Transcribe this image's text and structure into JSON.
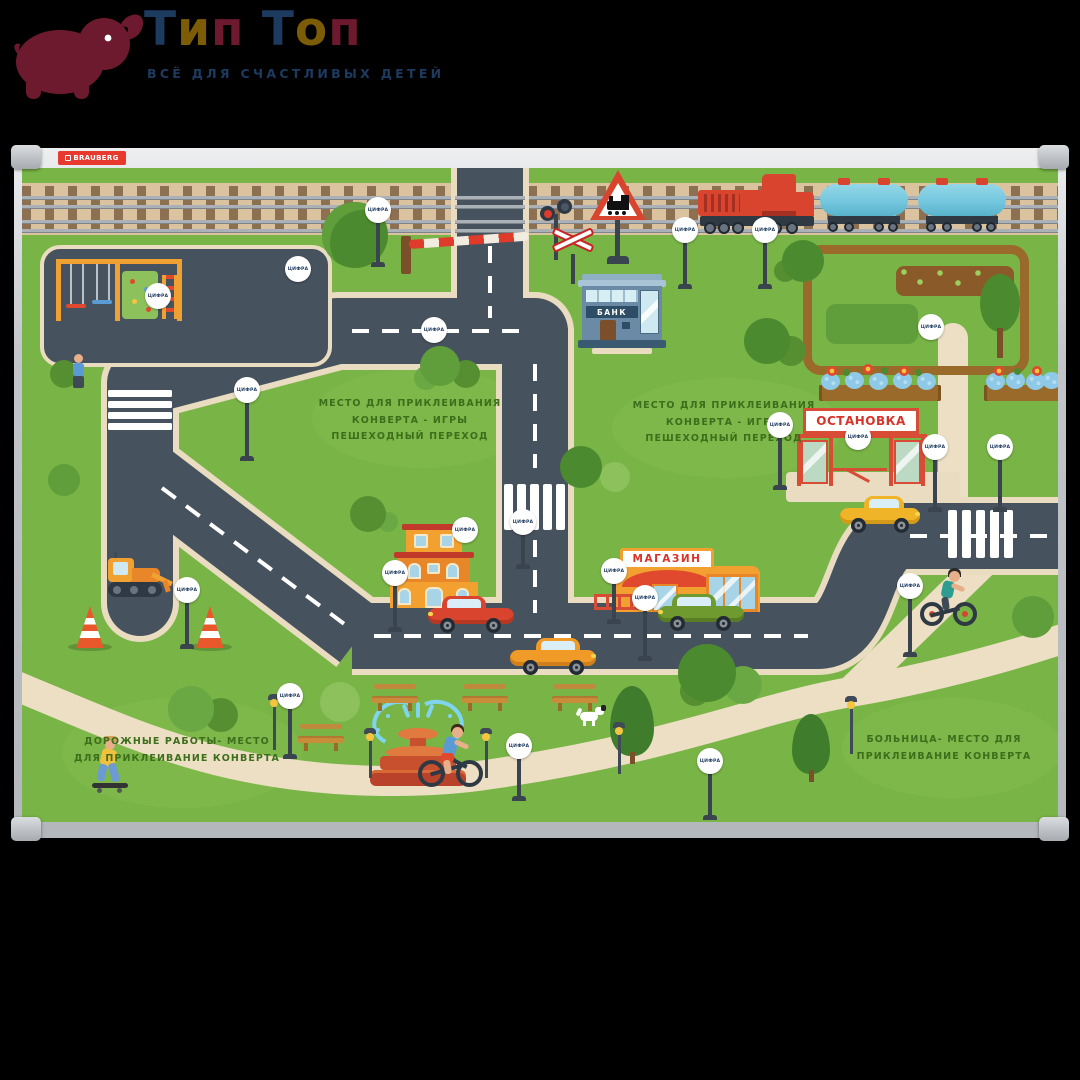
{
  "logo": {
    "brand_letters": [
      {
        "ch": "Т"
      },
      {
        "ch": "и"
      },
      {
        "ch": "п"
      },
      {
        "ch": "Т"
      },
      {
        "ch": "о"
      },
      {
        "ch": "п"
      }
    ],
    "tagline": "ВСЁ ДЛЯ СЧАСТЛИВЫХ ДЕТЕЙ",
    "colors": {
      "maroon": "#6e1a2e",
      "navy": "#1d3a5f",
      "gold": "#7d5c07"
    }
  },
  "board": {
    "brand_label": "BRAUBERG"
  },
  "map": {
    "marker_label": "ЦИФРА",
    "signs": {
      "bank": "БАНК",
      "shop": "МАГАЗИН",
      "bus_stop": "ОСТАНОВКА"
    },
    "notes": {
      "envelope_left": [
        "МЕСТО ДЛЯ ПРИКЛЕИВАНИЯ",
        "КОНВЕРТА - ИГРЫ",
        "ПЕШЕХОДНЫЙ ПЕРЕХОД"
      ],
      "envelope_right": [
        "МЕСТО ДЛЯ ПРИКЛЕИВАНИЯ",
        "КОНВЕРТА - ИГРЫ",
        "ПЕШЕХОДНЫЙ ПЕРЕХОД"
      ],
      "roadworks": [
        "ДОРОЖНЫЕ РАБОТЫ- МЕСТО",
        "ДЛЯ ПРИКЛЕИВАНИЕ КОНВЕРТА"
      ],
      "hospital": [
        "БОЛЬНИЦА- МЕСТО ДЛЯ",
        "ПРИКЛЕИВАНИЕ КОНВЕРТА"
      ]
    },
    "colors": {
      "grass": "#79b446",
      "road": "#47525f",
      "road_edge": "#e9dcc0",
      "path": "#ecdfc4",
      "rail_band": "#dcc3a0",
      "brand_red": "#e8392e",
      "note_green": "#3c6e1b",
      "accent_red": "#d84b35"
    }
  }
}
